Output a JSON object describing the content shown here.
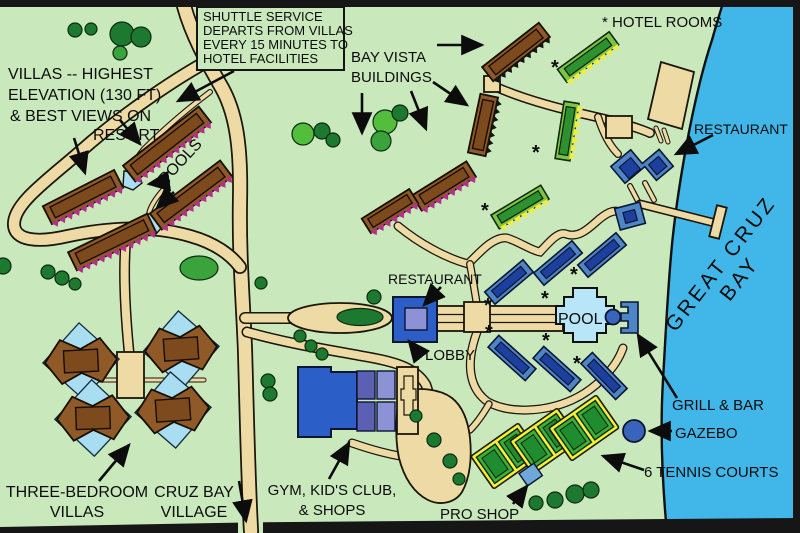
{
  "colors": {
    "land": "#c9e9bd",
    "water": "#41b6e8",
    "road": "#eedaa4",
    "villa_brown": "#8f5a28",
    "villa_brown_dark": "#7d4a1e",
    "saw_magenta": "#b5308a",
    "saw_yellow": "#f2ee3a",
    "bld_green": "#7cc544",
    "bld_green_dark": "#2e9130",
    "bld_blue": "#4d86c6",
    "bld_navy": "#1d3f9e",
    "royal_blue": "#2b5fc7",
    "slate_dark": "#5c60b5",
    "slate_light": "#8d92d6",
    "pool_blue": "#b8e6f8",
    "pool_small": "#a9ddf1",
    "tennis_yellow": "#f2ee3a",
    "court_green": "#3cae3c",
    "court_green_dark": "#1f8c2f",
    "tree_dark": "#1e7930",
    "tree_mid": "#3aa33c",
    "tree_bright": "#52be3b",
    "proshop_blue": "#6fa8d8",
    "gazebo_blue": "#3a64bc"
  },
  "labels": {
    "asterisk": "*",
    "villas_note": [
      "VILLAS -- HIGHEST",
      "ELEVATION (130 FT)",
      "& BEST VIEWS ON",
      "RESORT"
    ],
    "shuttle_note": [
      "SHUTTLE SERVICE",
      "DEPARTS FROM VILLAS",
      "EVERY 15 MINUTES TO",
      "HOTEL FACILITIES"
    ],
    "bay_vista": [
      "BAY VISTA",
      "BUILDINGS"
    ],
    "hotel_rooms": "* HOTEL ROOMS",
    "restaurant_beach": "RESTAURANT",
    "restaurant_main": "RESTAURANT",
    "lobby": "LOBBY",
    "pools": "POOLS",
    "pool": "POOL",
    "grill_bar": "GRILL & BAR",
    "gazebo": "GAZEBO",
    "tennis": "6 TENNIS COURTS",
    "pro_shop": "PRO SHOP",
    "three_bedroom": [
      "THREE-BEDROOM",
      "VILLAS"
    ],
    "cruz_bay_village": [
      "CRUZ BAY",
      "VILLAGE"
    ],
    "gym": [
      "GYM,  KID'S CLUB,",
      "& SHOPS"
    ],
    "bay_name": [
      "GREAT CRUZ",
      "BAY"
    ]
  }
}
